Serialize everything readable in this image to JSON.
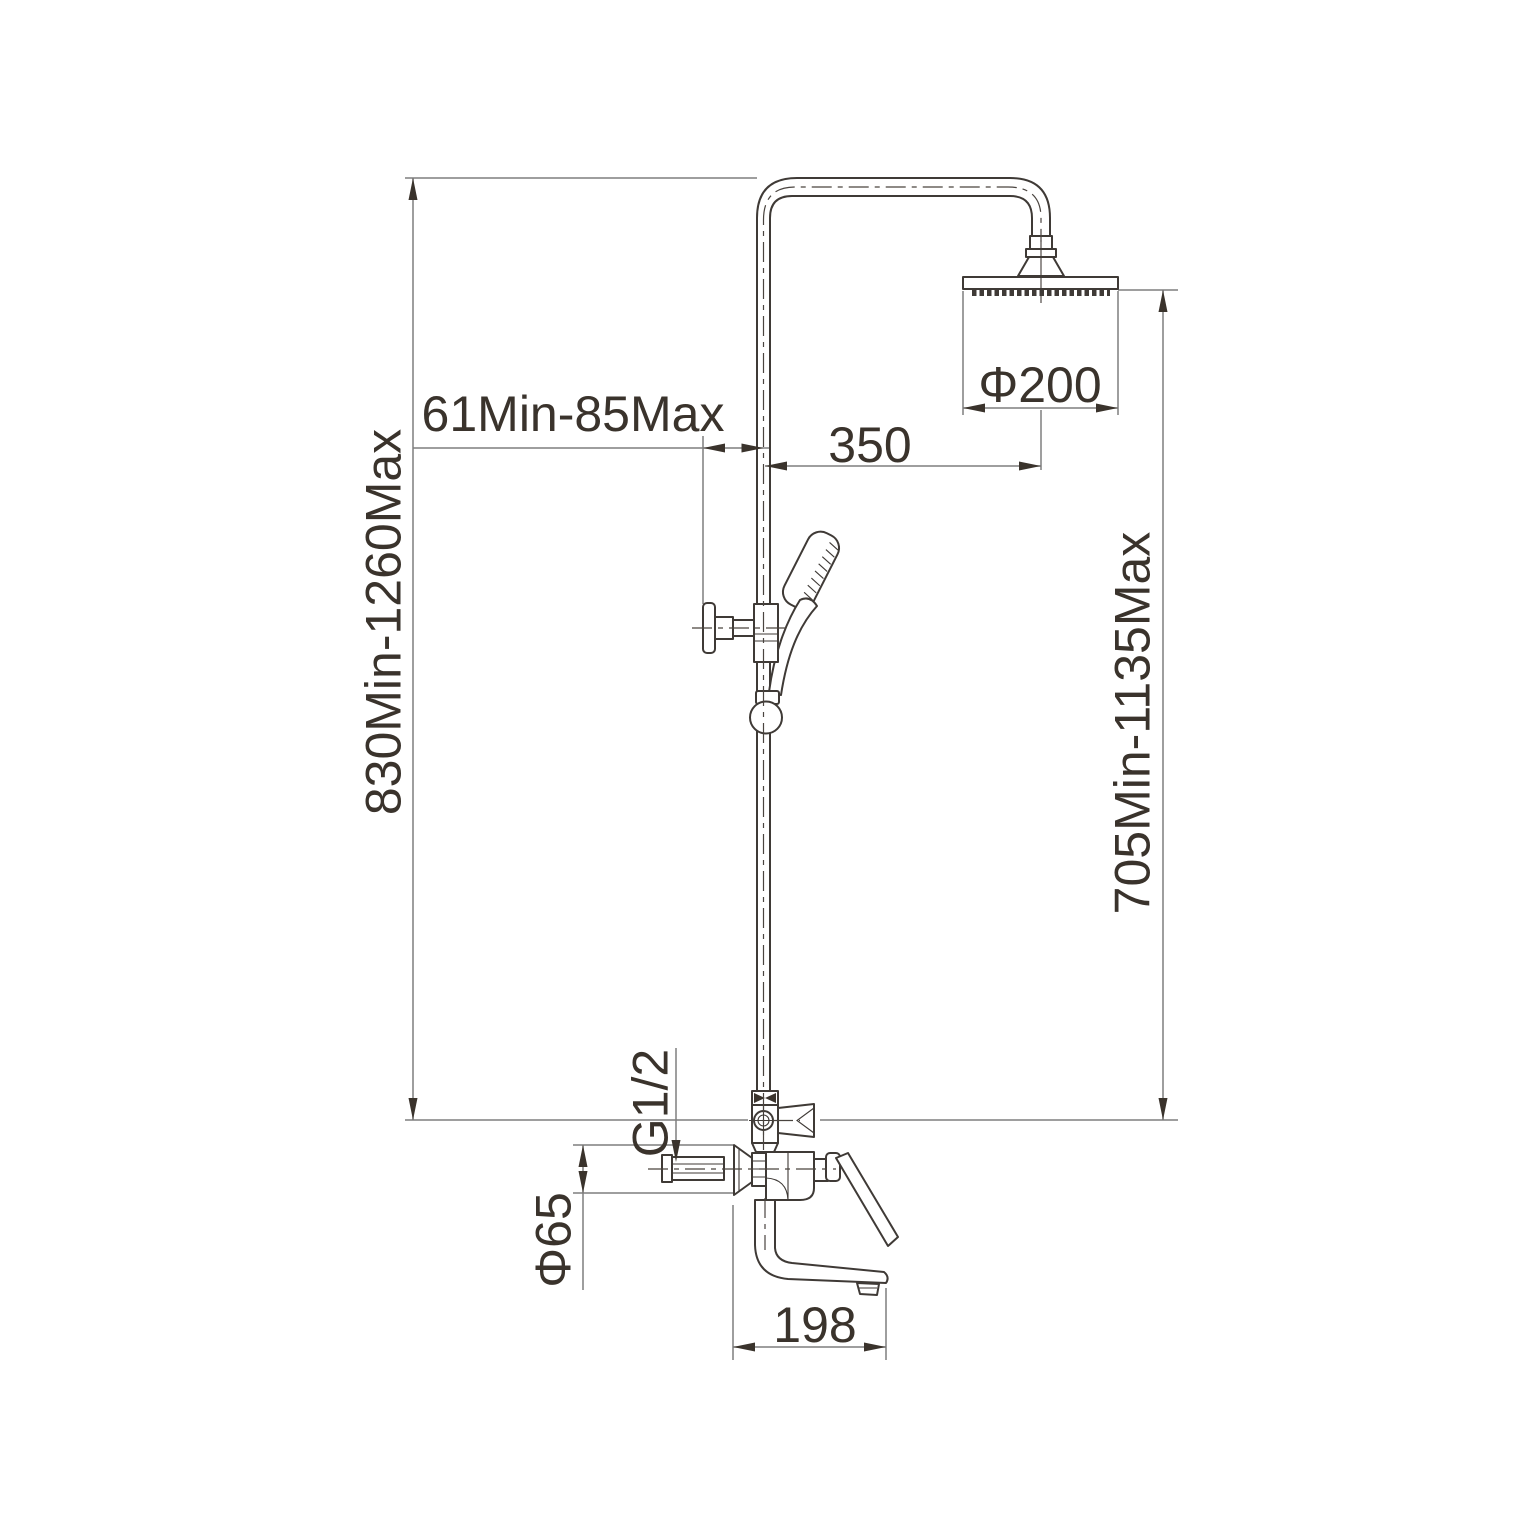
{
  "drawing": {
    "kind": "technical dimension drawing",
    "subject": "wall-mounted shower column with overhead rain shower, hand shower and tub spout mixer",
    "units": "mm"
  },
  "labels": {
    "column_height": "830Min-1260Max",
    "bracket_offset": "61Min-85Max",
    "arm_reach": "350",
    "head_diameter": "Φ200",
    "head_height": "705Min-1135Max",
    "inlet_thread": "G1/2",
    "escutcheon_diameter": "Φ65",
    "spout_length": "198"
  },
  "colors": {
    "background": "#ffffff",
    "object_line": "#3f3a36",
    "dimension_line": "#7f7f7f",
    "text": "#3a332c"
  }
}
